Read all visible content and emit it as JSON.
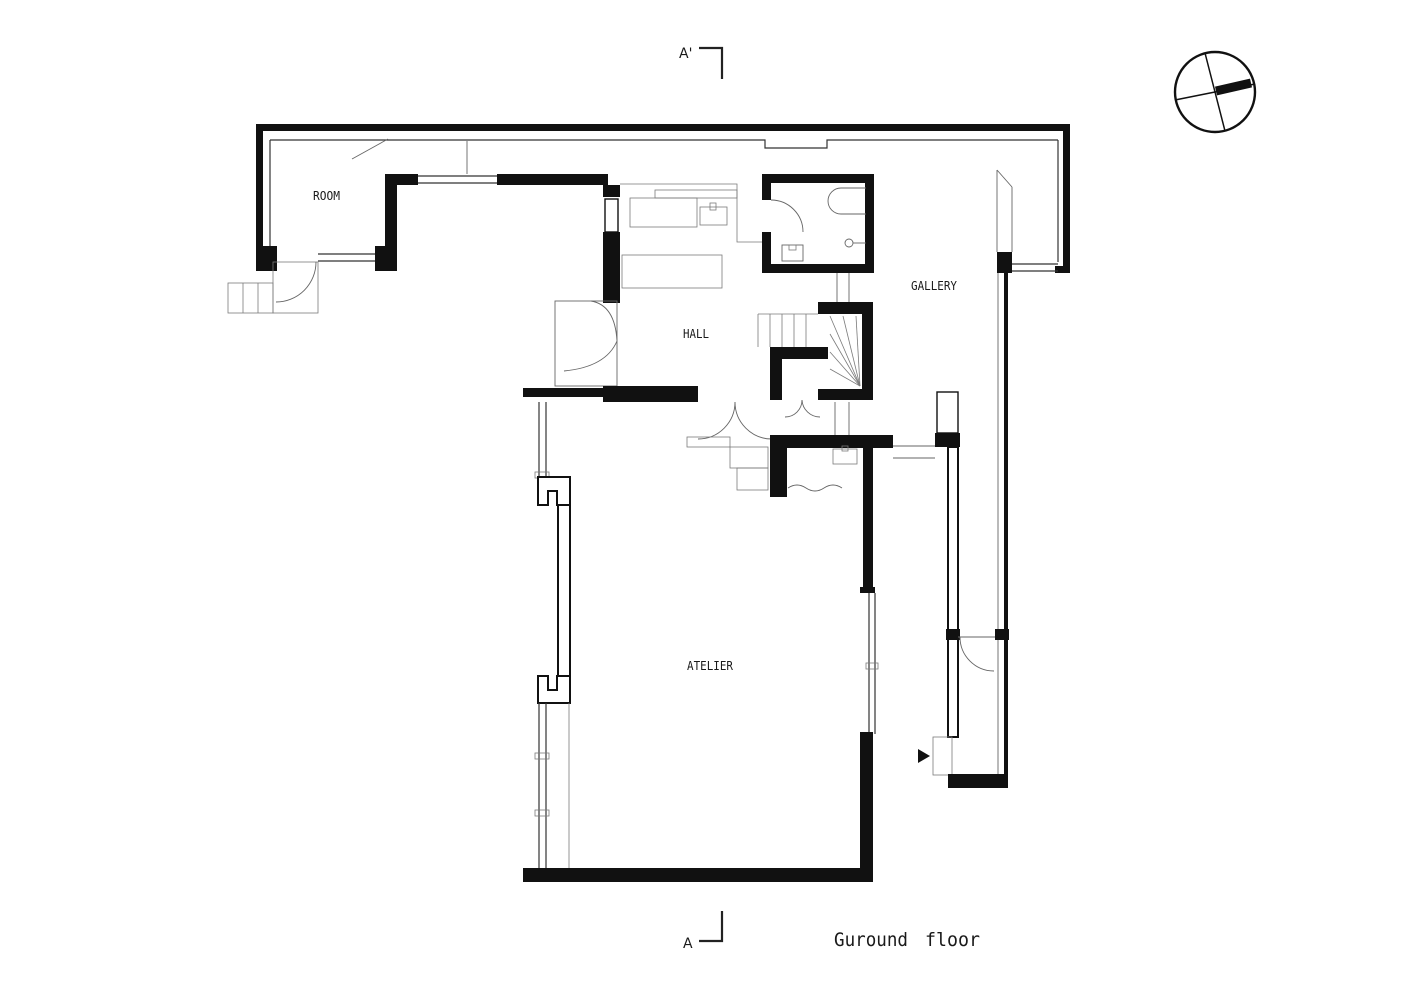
{
  "title": {
    "text": "Guround floor",
    "words": [
      "Guround",
      "floor"
    ]
  },
  "labels": {
    "room": "ROOM",
    "hall": "HALL",
    "gallery": "GALLERY",
    "atelier": "ATELIER"
  },
  "section": {
    "top": "A'",
    "bottom": "A"
  },
  "icons": {
    "north_arrow": "north-arrow-icon",
    "entrance_arrow": "entrance-arrow-icon"
  },
  "colors": {
    "wall": "#111111",
    "thin_line": "#666666",
    "window_line": "#333333",
    "background": "#ffffff"
  }
}
